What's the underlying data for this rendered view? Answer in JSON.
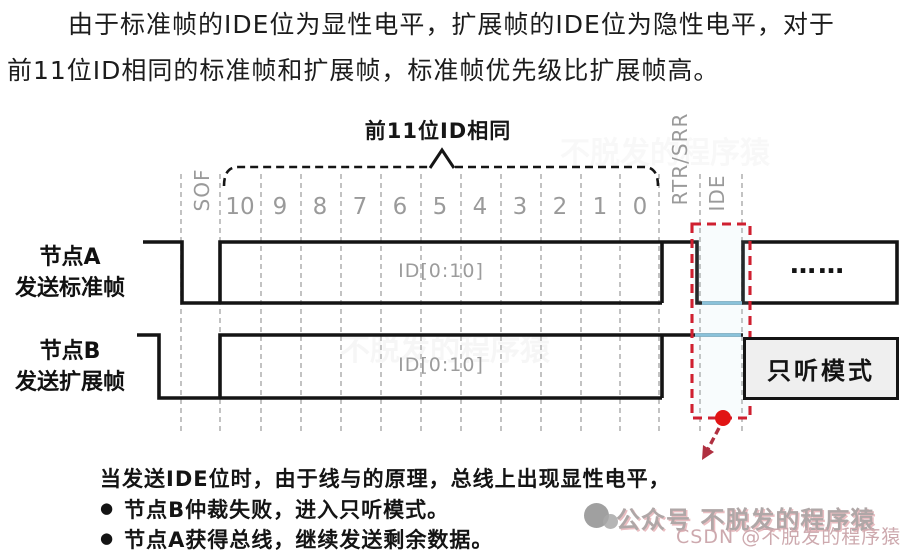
{
  "intro": {
    "line1": "由于标准帧的IDE位为显性电平，扩展帧的IDE位为隐性电平，对于",
    "line2": "前11位ID相同的标准帧和扩展帧，标准帧优先级比扩展帧高。"
  },
  "diagram": {
    "brace_label": "前11位ID相同",
    "sof_label": "SOF",
    "rtr_srr_label": "RTR/SRR",
    "ide_label": "IDE",
    "bit_numbers": [
      "10",
      "9",
      "8",
      "7",
      "6",
      "5",
      "4",
      "3",
      "2",
      "1",
      "0"
    ],
    "node_a": {
      "name": "节点A",
      "desc": "发送标准帧",
      "id_field": "ID[0:10]",
      "continuation": "……"
    },
    "node_b": {
      "name": "节点B",
      "desc": "发送扩展帧",
      "id_field": "ID[0:10]",
      "listen_mode": "只听模式"
    },
    "colors": {
      "waveform": "#141414",
      "bit_grid": "#b4b4b4",
      "muted_label": "#9a9a9a",
      "ide_highlight_box": "#cf2030",
      "arbitration_dot": "#e11414",
      "bus_level_highlight": "#85bfd8",
      "listen_box_fill": "#efefef"
    }
  },
  "notes": {
    "line1": "当发送IDE位时，由于线与的原理，总线上出现显性电平，",
    "bullet_glyph": "●",
    "bullets": [
      "节点B仲裁失败，进入只听模式。",
      "节点A获得总线，继续发送剩余数据。"
    ]
  },
  "watermark": {
    "line1": "公众号 不脱发的程序猿",
    "line2": "CSDN @不脱发的程序猿",
    "ghost": "不脱发的程序猿"
  }
}
